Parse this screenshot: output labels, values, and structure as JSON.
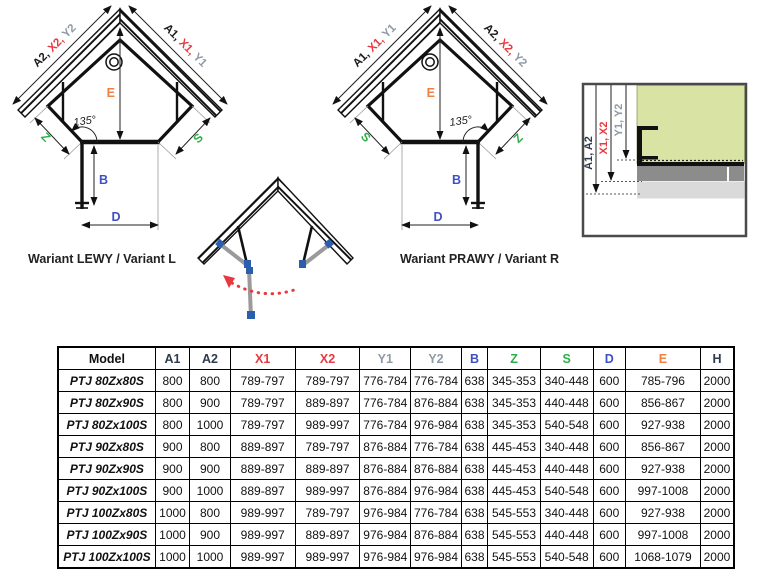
{
  "colors": {
    "accent_red": "#e8393f",
    "accent_gray_blue": "#8e9aa6",
    "accent_blue": "#3f51c1",
    "accent_green": "#2fae49",
    "accent_orange": "#f08142",
    "accent_dark": "#2f3b4c",
    "wall_green": "#d8e3a4",
    "tray_gray": "#8c8c8c",
    "base_gray": "#dadada"
  },
  "diagram_left": {
    "caption": "Wariant LEWY / Variant L",
    "left_wall": {
      "p1": "A2, ",
      "p2": "X2, ",
      "p3": "Y2"
    },
    "right_wall": {
      "p1": "A1, ",
      "p2": "X1, ",
      "p3": "Y1"
    },
    "angle": "135°",
    "e": "E",
    "b": "B",
    "d": "D",
    "z": "Z",
    "s": "S"
  },
  "diagram_right": {
    "caption": "Wariant PRAWY / Variant R",
    "left_wall": {
      "p1": "A1, ",
      "p2": "X1, ",
      "p3": "Y1"
    },
    "right_wall": {
      "p1": "A2, ",
      "p2": "X2, ",
      "p3": "Y2"
    },
    "angle": "135°",
    "e": "E",
    "b": "B",
    "d": "D",
    "z": "Z",
    "s": "S"
  },
  "detail": {
    "dim_a": "A1, A2",
    "dim_x": "X1, X2",
    "dim_y": "Y1, Y2"
  },
  "table": {
    "headers": [
      "Model",
      "A1",
      "A2",
      "X1",
      "X2",
      "Y1",
      "Y2",
      "B",
      "Z",
      "S",
      "D",
      "E",
      "H"
    ],
    "rows": [
      {
        "model": "PTJ 80Zx80S",
        "values": [
          "800",
          "800",
          "789-797",
          "789-797",
          "776-784",
          "776-784",
          "638",
          "345-353",
          "340-448",
          "600",
          "785-796",
          "2000"
        ]
      },
      {
        "model": "PTJ 80Zx90S",
        "values": [
          "800",
          "900",
          "789-797",
          "889-897",
          "776-784",
          "876-884",
          "638",
          "345-353",
          "440-448",
          "600",
          "856-867",
          "2000"
        ]
      },
      {
        "model": "PTJ 80Zx100S",
        "values": [
          "800",
          "1000",
          "789-797",
          "989-997",
          "776-784",
          "976-984",
          "638",
          "345-353",
          "540-548",
          "600",
          "927-938",
          "2000"
        ]
      },
      {
        "model": "PTJ 90Zx80S",
        "values": [
          "900",
          "800",
          "889-897",
          "789-797",
          "876-884",
          "776-784",
          "638",
          "445-453",
          "340-448",
          "600",
          "856-867",
          "2000"
        ]
      },
      {
        "model": "PTJ 90Zx90S",
        "values": [
          "900",
          "900",
          "889-897",
          "889-897",
          "876-884",
          "876-884",
          "638",
          "445-453",
          "440-448",
          "600",
          "927-938",
          "2000"
        ]
      },
      {
        "model": "PTJ 90Zx100S",
        "values": [
          "900",
          "1000",
          "889-897",
          "989-997",
          "876-884",
          "976-984",
          "638",
          "445-453",
          "540-548",
          "600",
          "997-1008",
          "2000"
        ]
      },
      {
        "model": "PTJ 100Zx80S",
        "values": [
          "1000",
          "800",
          "989-997",
          "789-797",
          "976-984",
          "776-784",
          "638",
          "545-553",
          "340-448",
          "600",
          "927-938",
          "2000"
        ]
      },
      {
        "model": "PTJ 100Zx90S",
        "values": [
          "1000",
          "900",
          "989-997",
          "889-897",
          "976-984",
          "876-884",
          "638",
          "545-553",
          "440-448",
          "600",
          "997-1008",
          "2000"
        ]
      },
      {
        "model": "PTJ 100Zx100S",
        "values": [
          "1000",
          "1000",
          "989-997",
          "989-997",
          "976-984",
          "976-984",
          "638",
          "545-553",
          "540-548",
          "600",
          "1068-1079",
          "2000"
        ]
      }
    ]
  }
}
